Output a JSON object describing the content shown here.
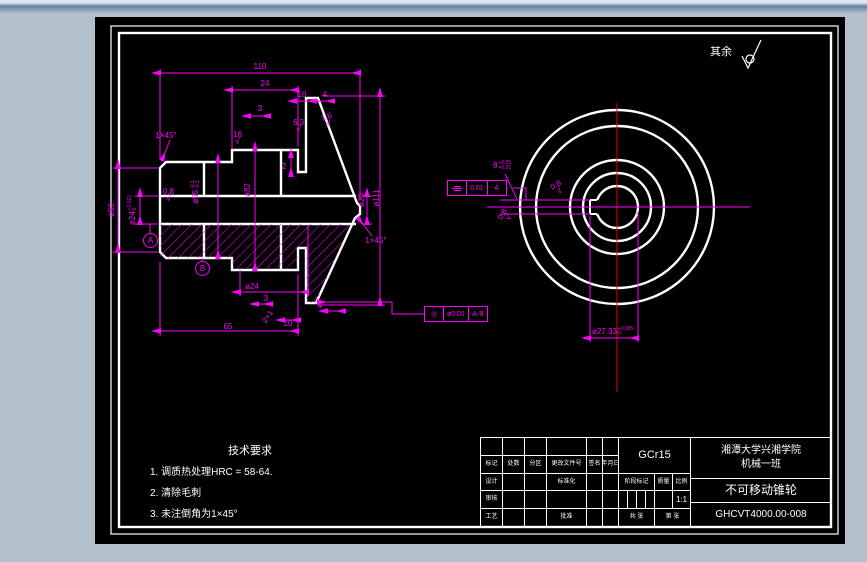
{
  "drawing": {
    "surface_note": "其余",
    "dims": {
      "len_total": "110",
      "len_24": "24",
      "len_10": "10",
      "len_4": "4",
      "len_3": "3",
      "len_2": "2",
      "dia50": "ø50",
      "dia24_base": "ø24",
      "dia24_up": "+0.021",
      "dia24_lo": "0",
      "dia55_base": "ø55",
      "dia55_up": "-0.1",
      "dia55_lo": "-0.3",
      "dia82": "ø82",
      "dia20": "ø20",
      "dia111": "ø111",
      "chamfer_left": "1×45°",
      "chamfer_right": "1×45°",
      "dia24_bottom": "ø24",
      "len3_bottom": "3",
      "len10_bottom": "10",
      "len4_bottom": "4",
      "len65": "65",
      "groove": "2×1",
      "rough16": "16",
      "rough63": "6.3",
      "rough16c": "1.6",
      "rough08": "0.8",
      "check": "√"
    },
    "datums": {
      "a": "A",
      "b": "B"
    },
    "fcf1": {
      "symbol": "◎",
      "tol": "ø0.01",
      "datum": "A-B"
    },
    "fcf2": {
      "tol": "0.01",
      "datum": "A"
    },
    "right_view": {
      "keyway_base": "8",
      "keyway_up": "+0.05",
      "keyway_lo": "+0.01",
      "keydepth_base": "ø27.33",
      "keydepth_up": "+0.065",
      "keydepth_lo": "0",
      "rough08a": "0.8",
      "rough08b": "0.8"
    },
    "tech": {
      "title": "技术要求",
      "line1": "1.  调质热处理HRC = 58-64.",
      "line2": "2.  清除毛刺",
      "line3": "3. 未注倒角为1×45°"
    },
    "titleblock": {
      "material": "GCr15",
      "school1": "湘潭大学兴湘学院",
      "school2": "机械一班",
      "part": "不可移动锥轮",
      "number": "GHCVT4000.00-008",
      "scale_val": "1:1",
      "mark": "标记",
      "count": "处数",
      "zone": "分区",
      "doc": "更改文件号",
      "sign": "签名",
      "date": "年月日",
      "design": "设计",
      "standardize": "标准化",
      "stage": "阶段标记",
      "weight": "质量",
      "scale": "比例",
      "check": "审核",
      "craft": "工艺",
      "approve": "批准",
      "sheets": "共 张",
      "sheetno": "第 张"
    }
  }
}
